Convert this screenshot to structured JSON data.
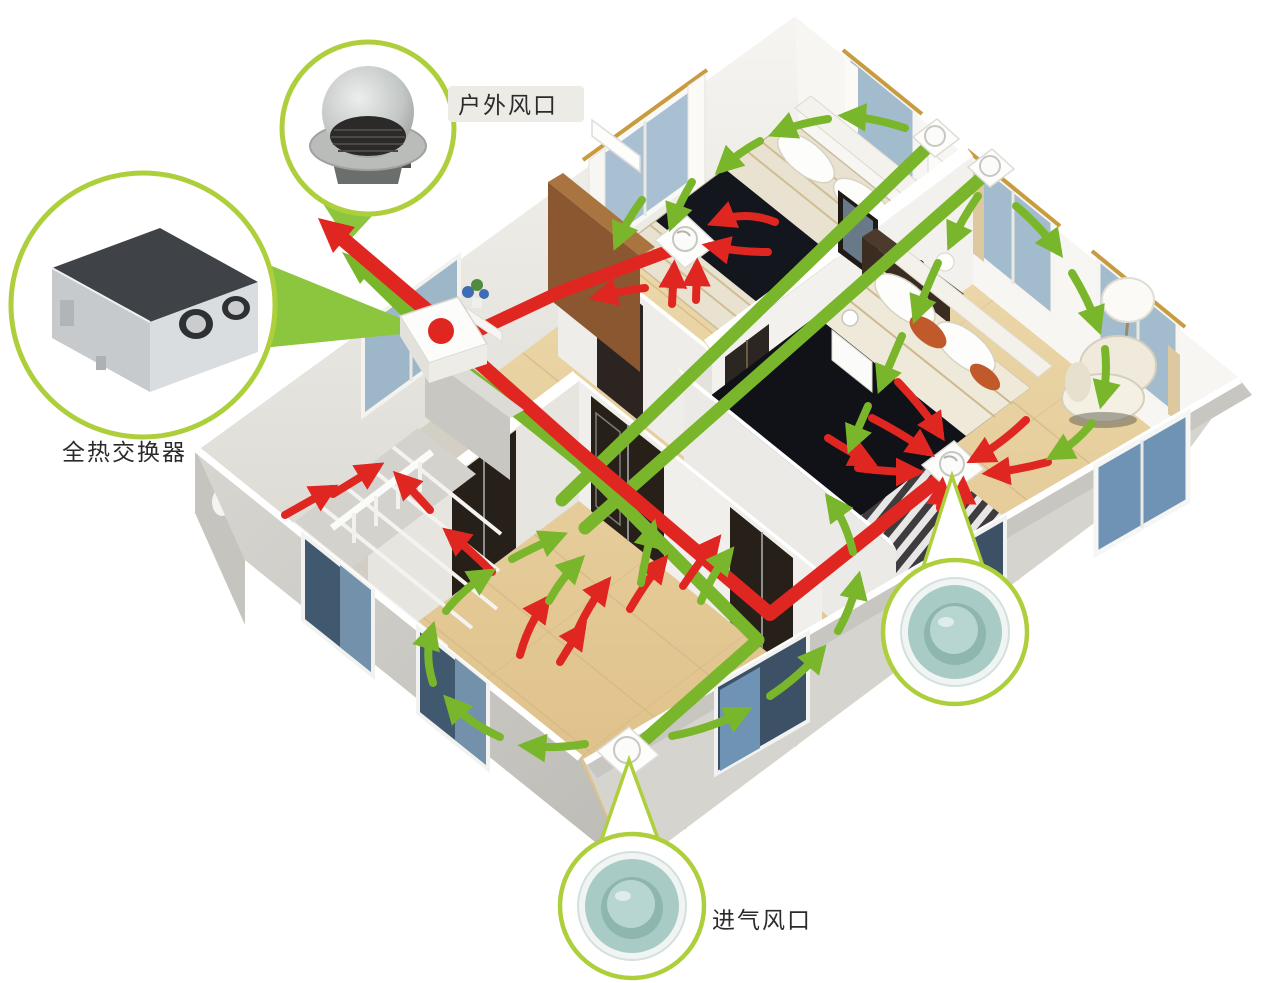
{
  "figure": {
    "type": "isometric-home-ventilation-diagram",
    "description_visible_text_only": true
  },
  "labels": {
    "heat_exchanger": "全热交换器",
    "outdoor_vent": "户外风口",
    "intake_vent": "进气风口"
  },
  "callouts": [
    {
      "id": "heat-exchanger-callout",
      "label": "全热交换器",
      "content": "ceiling heat-recovery ventilator unit with two round duct ports"
    },
    {
      "id": "outdoor-vent-callout",
      "label": "户外风口",
      "content": "stainless dome outdoor wall vent with mesh grille"
    },
    {
      "id": "exhaust-diffuser-callout",
      "label": "",
      "content": "round teal ceiling diffuser"
    },
    {
      "id": "intake-diffuser-callout",
      "label": "进气风口",
      "content": "round teal ceiling diffuser"
    }
  ],
  "colors": {
    "exhaust_airflow_red": "#e02621",
    "supply_airflow_green": "#7ab62c",
    "duct_green": "#7ab62c",
    "duct_red": "#e02621",
    "callout_ring_green": "#aecf3c",
    "callout_pointer_green": "#8cc63f",
    "diffuser_teal": "#a9cbc6",
    "floor_wood": "#e6c795",
    "interior_wall": "#f0efeb",
    "exterior_wall": "#d2d0cb",
    "background": "#ffffff"
  }
}
